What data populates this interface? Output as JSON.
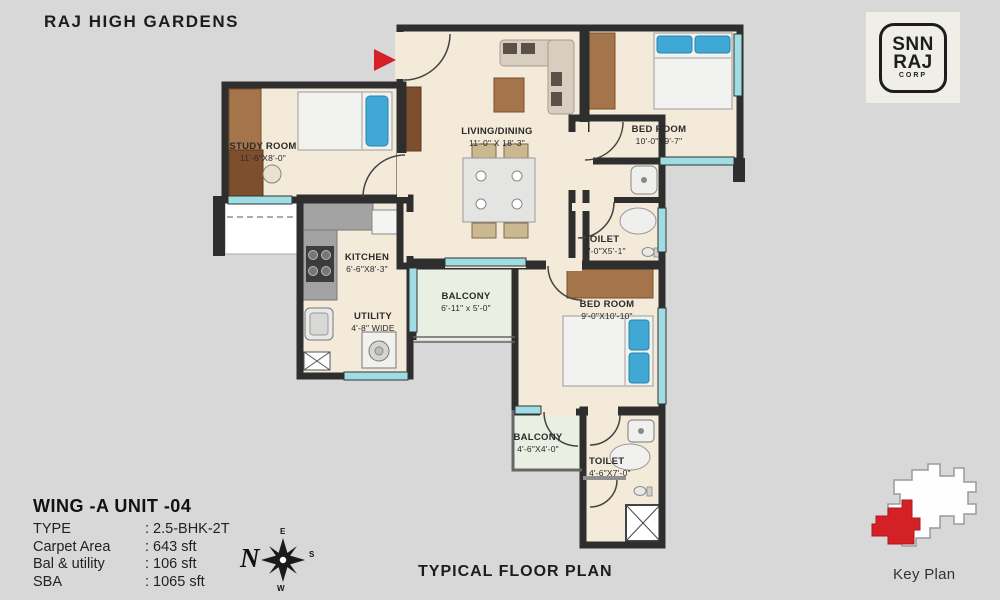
{
  "header": {
    "title": "RAJ HIGH GARDENS"
  },
  "logo": {
    "line1": "SNN",
    "line2": "RAJ",
    "line3": "CORP"
  },
  "plan": {
    "rooms": [
      {
        "id": "study",
        "name": "STUDY ROOM",
        "dims": "11'-6\"X8'-0\""
      },
      {
        "id": "living",
        "name": "LIVING/DINING",
        "dims": "11'-0\" X 18'-3\""
      },
      {
        "id": "bed1",
        "name": "BED ROOM",
        "dims": "10'-0\"X9'-7\""
      },
      {
        "id": "toilet1",
        "name": "TOILET",
        "dims": "5'-0\"X5'-1\""
      },
      {
        "id": "bed2",
        "name": "BED ROOM",
        "dims": "9'-0\"X10'-10\""
      },
      {
        "id": "kitchen",
        "name": "KITCHEN",
        "dims": "6'-6\"X8'-3\""
      },
      {
        "id": "utility",
        "name": "UTILITY",
        "dims": "4'-8\" WIDE"
      },
      {
        "id": "balcony1",
        "name": "BALCONY",
        "dims": "6'-11\" x 5'-0\""
      },
      {
        "id": "balcony2",
        "name": "BALCONY",
        "dims": "4'-6\"X4'-0\""
      },
      {
        "id": "toilet2",
        "name": "TOILET",
        "dims": "4'-6\"X7'-0\""
      }
    ]
  },
  "info": {
    "title": "WING -A  UNIT -04",
    "rows": [
      {
        "label": "TYPE",
        "value": ": 2.5-BHK-2T"
      },
      {
        "label": "Carpet Area",
        "value": ": 643 sft"
      },
      {
        "label": "Bal & utility",
        "value": ": 106 sft"
      },
      {
        "label": "SBA",
        "value": ": 1065 sft"
      }
    ]
  },
  "compass": {
    "n": "N",
    "e": "E",
    "s": "S",
    "w": "W"
  },
  "footer": {
    "plan_title": "TYPICAL FLOOR PLAN"
  },
  "key_plan": {
    "label": "Key Plan"
  },
  "colors": {
    "background": "#d8d8d8",
    "wall": "#2e2e2e",
    "floor": "#f4ead9",
    "balcony_floor": "#eaefe3",
    "window": "#9fdde4",
    "accent_red": "#d42127",
    "wood": "#a4744b",
    "pillow_blue": "#3fa8d5"
  }
}
